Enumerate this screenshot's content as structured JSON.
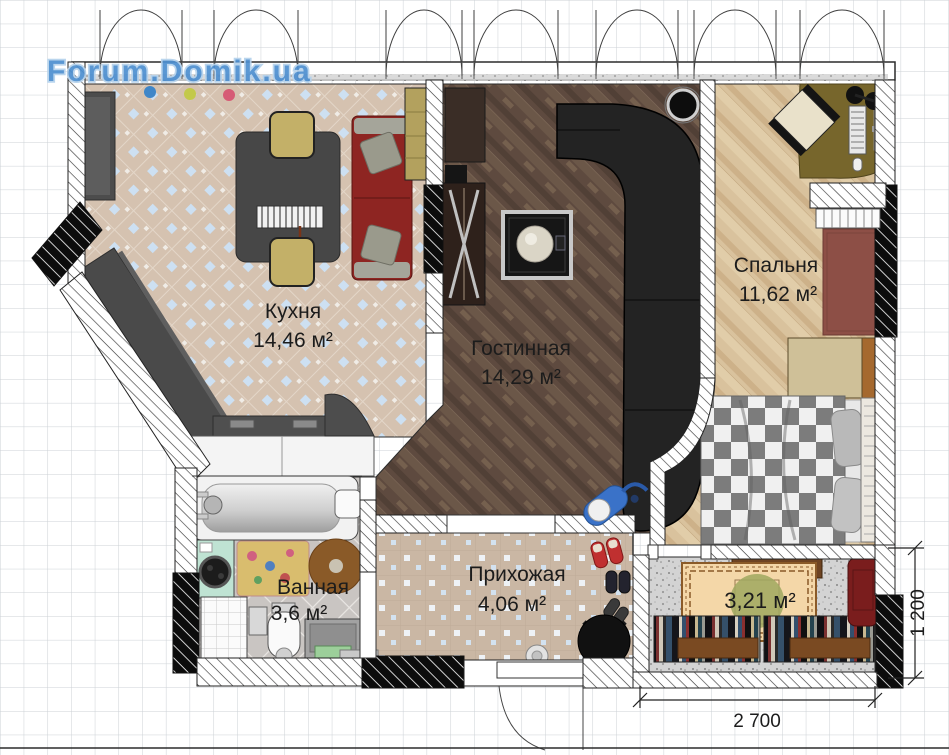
{
  "watermark": "Forum.Domik.ua",
  "rooms": {
    "kitchen": {
      "label": "Кухня",
      "area": "14,46 м²"
    },
    "living": {
      "label": "Гостинная",
      "area": "14,29 м²"
    },
    "bedroom": {
      "label": "Спальня",
      "area": "11,62 м²"
    },
    "bathroom": {
      "label": "Ванная",
      "area": "3,6 м²"
    },
    "hallway": {
      "label": "Прихожая",
      "area": "4,06 м²"
    },
    "balcony": {
      "area": "3,21 м²"
    }
  },
  "dimensions": {
    "balcony_width": "2 700",
    "balcony_depth": "1 200"
  },
  "colors": {
    "watermark_blue": "#4d8fd0",
    "grid_line": "#ccd1d6",
    "kitchen_floor": "#d5c2b0",
    "living_floor": "#5e4a3f",
    "bedroom_floor": "#d9c29d",
    "bathroom_floor": "#c9c5c2",
    "hallway_floor": "#cab7a4",
    "balcony_floor": "#d3d3d3",
    "sofa_red": "#8e2522",
    "corner_sofa_black": "#232323",
    "label_text": "#1c1c1c"
  }
}
